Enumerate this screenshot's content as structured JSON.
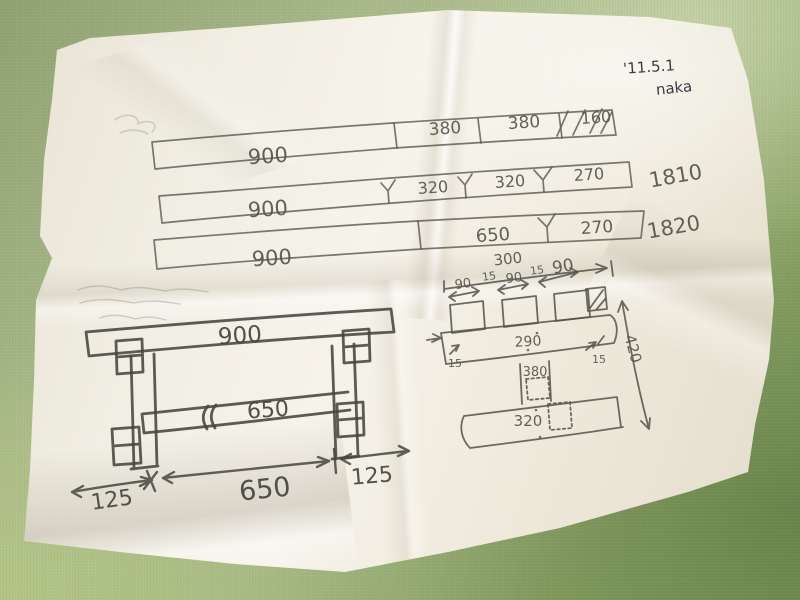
{
  "scene": {
    "description": "photo of hand-drawn bench plan sketch on crumpled paper on green table",
    "colors": {
      "table": "#9db177",
      "paper": "#f1eee3",
      "pencil": "#5b5b52",
      "ink": "#31313b"
    }
  },
  "note": {
    "date": "'11.5.1",
    "name": "naka"
  },
  "cut_list_bars": {
    "rows": [
      {
        "segments": [
          "900",
          "380",
          "380",
          "160"
        ],
        "total": ""
      },
      {
        "segments": [
          "900",
          "320",
          "320",
          "270"
        ],
        "total": "1810"
      },
      {
        "segments": [
          "900",
          "650",
          "270"
        ],
        "total": "1820"
      }
    ]
  },
  "bench_elevation": {
    "top_length": "900",
    "stretcher_length": "650",
    "dim_left_overhang": "125",
    "dim_span": "650",
    "dim_right_overhang": "125"
  },
  "joint_detail": {
    "overall_width": "300",
    "top_dims": [
      "90",
      "15",
      "90",
      "15",
      "90"
    ],
    "mid_rail_length": "290",
    "inset_left": "15",
    "inset_right": "15",
    "post_length": "380",
    "bottom_rail_length": "320",
    "overall_height": "420"
  }
}
